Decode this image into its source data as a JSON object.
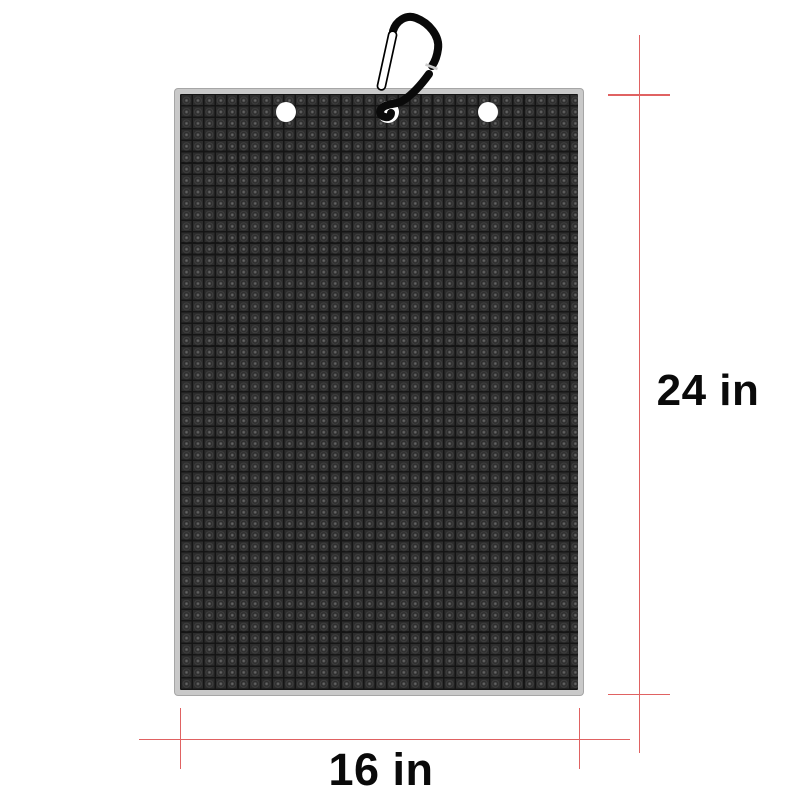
{
  "diagram": {
    "height_label": "24 in",
    "width_label": "16 in"
  },
  "icons": {
    "carabiner": "carabiner-clip-icon"
  },
  "colors": {
    "dimension_red": "#e06262",
    "mat_surface": "#2d2d2d",
    "mat_groove": "#151515",
    "mat_border": "#c9c9c9",
    "grommet": "#ffffff",
    "carabiner": "#0a0a0a",
    "label_text": "#0a0a0a"
  }
}
